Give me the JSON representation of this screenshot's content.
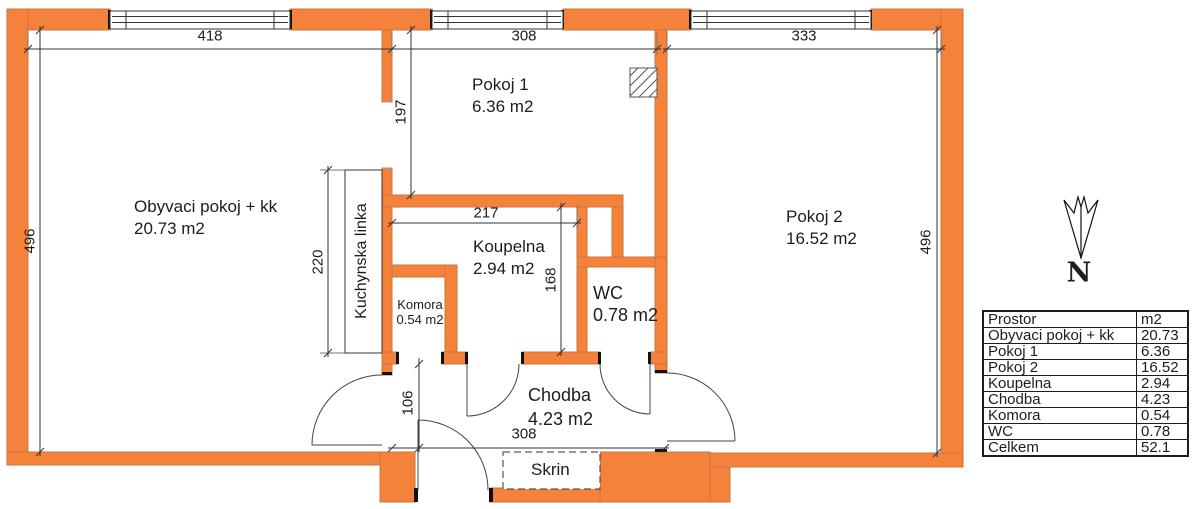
{
  "rooms": {
    "living": {
      "name": "Obyvaci pokoj + kk",
      "area": "20.73 m2"
    },
    "pokoj1": {
      "name": "Pokoj 1",
      "area": "6.36 m2"
    },
    "pokoj2": {
      "name": "Pokoj 2",
      "area": "16.52 m2"
    },
    "koupelna": {
      "name": "Koupelna",
      "area": "2.94 m2"
    },
    "komora": {
      "name": "Komora",
      "area": "0.54 m2"
    },
    "wc": {
      "name": "WC",
      "area": "0.78 m2"
    },
    "chodba": {
      "name": "Chodba",
      "area": "4.23 m2"
    },
    "skrin": {
      "name": "Skrin"
    },
    "kitchen": {
      "name": "Kuchynska linka"
    }
  },
  "dimensions_cm": {
    "living_width": "418",
    "pokoj1_width": "308",
    "pokoj2_width": "333",
    "left_depth": "496",
    "right_depth": "496",
    "pokoj1_depth": "197",
    "koupelna_width": "217",
    "koupelna_depth": "168",
    "kitchen_length": "220",
    "chodba_depth": "106",
    "chodba_width": "308"
  },
  "compass": {
    "north": "N"
  },
  "legend_table": {
    "rows": [
      {
        "label": "Prostor",
        "value": "m2"
      },
      {
        "label": "Obyvaci pokoj + kk",
        "value": "20.73"
      },
      {
        "label": "Pokoj 1",
        "value": "6.36"
      },
      {
        "label": "Pokoj 2",
        "value": "16.52"
      },
      {
        "label": "Koupelna",
        "value": "2.94"
      },
      {
        "label": "Chodba",
        "value": "4.23"
      },
      {
        "label": "Komora",
        "value": "0.54"
      },
      {
        "label": "WC",
        "value": "0.78"
      },
      {
        "label": "Celkem",
        "value": "52.1"
      }
    ]
  },
  "colors": {
    "wall_fill": "#F5823B",
    "wall_edge": "#C8743F",
    "line": "#333333"
  }
}
